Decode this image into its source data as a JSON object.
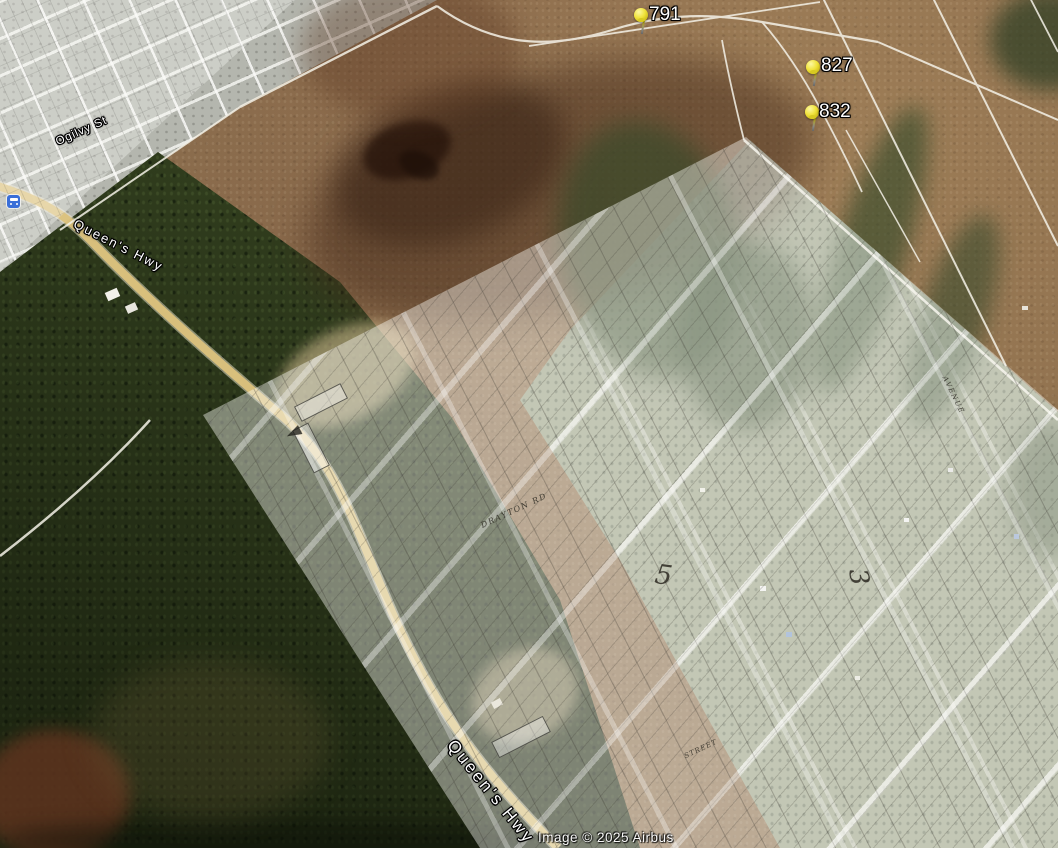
{
  "view": {
    "type": "satellite-map-with-plat-overlays",
    "attribution": "Image © 2025 Airbus"
  },
  "placemarks": [
    {
      "label": "791"
    },
    {
      "label": "827"
    },
    {
      "label": "832"
    }
  ],
  "road_labels": [
    {
      "text": "Ogilvy St"
    },
    {
      "text": "Queen's Hwy"
    },
    {
      "text": "Queen's Hwy"
    }
  ],
  "plat_overlay": {
    "labels": [
      {
        "text": "DRAYTON RD"
      },
      {
        "text": "5"
      },
      {
        "text": "3"
      },
      {
        "text": "STREET"
      },
      {
        "text": "AVENUE"
      }
    ]
  },
  "icons": [
    {
      "name": "bus-stop-icon"
    },
    {
      "name": "pushpin-icon"
    }
  ],
  "colors": {
    "pin_yellow": "#f0e33a",
    "highway_yellow": "#dcc27c",
    "forest_green": "#33401f",
    "terrain_brown": "#8a6a48",
    "overlay_white": "rgba(252,252,247,0.42)",
    "label_text": "#ffffff",
    "transit_blue": "#3a6fd8"
  }
}
